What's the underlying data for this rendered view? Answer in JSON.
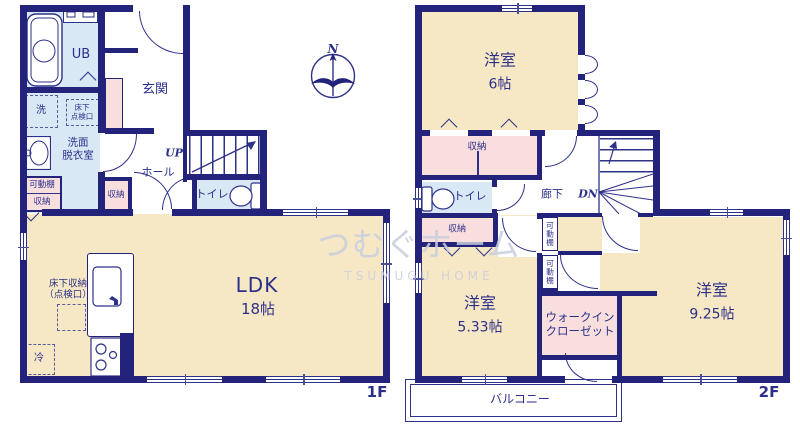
{
  "compass": {
    "north": "N"
  },
  "watermark": {
    "line1": "つむぐホーム",
    "line2": "TSUMUGU HOME"
  },
  "colors": {
    "wall": "#23237b",
    "line": "#2e3189",
    "text": "#2c2f8a",
    "room_cream": "#f7e8c5",
    "room_blue": "#d9e8f5",
    "room_pink": "#f9dede",
    "watermark": "#c8cede"
  },
  "f1": {
    "floor_label": "1F",
    "ub": "UB",
    "genkan": "玄関",
    "washer": "洗",
    "hatch_line1": "床下",
    "hatch_line2": "点検口",
    "washroom_line1": "洗面",
    "washroom_line2": "脱衣室",
    "shelf": "可動棚",
    "shelf_storage": "収納",
    "up": "UP",
    "hall": "ホール",
    "hall_storage": "収納",
    "toilet": "トイレ",
    "ldk_name": "LDK",
    "ldk_size": "18帖",
    "floor_storage_line1": "床下収納",
    "floor_storage_line2": "（点検口）",
    "fridge": "冷"
  },
  "f2": {
    "floor_label": "2F",
    "room6_name": "洋室",
    "room6_size": "6帖",
    "storage_north": "収納",
    "toilet": "トイレ",
    "storage_small": "収納",
    "corridor": "廊下",
    "dn": "DN",
    "shelf1": "可動棚",
    "shelf2": "可動棚",
    "wic_line1": "ウォークイン",
    "wic_line2": "クローゼット",
    "room533_name": "洋室",
    "room533_size": "5.33帖",
    "room925_name": "洋室",
    "room925_size": "9.25帖",
    "balcony": "バルコニー"
  }
}
